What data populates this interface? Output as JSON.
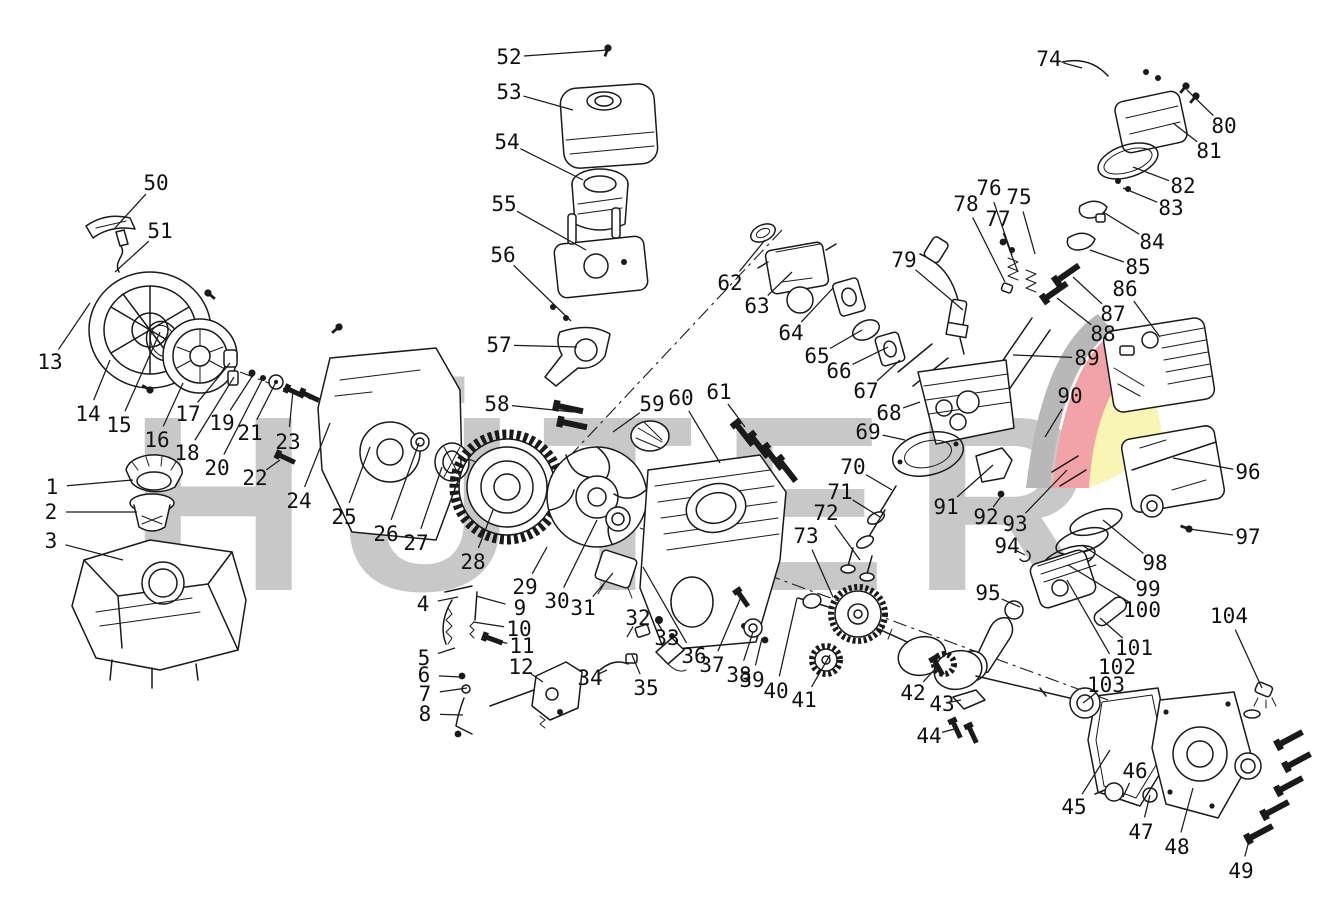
{
  "meta": {
    "background_color": "#ffffff",
    "line_color": "#1a1a1a",
    "label_color": "#111111"
  },
  "watermark": {
    "text": "HÜTER",
    "letter_color": "#c8c8c8",
    "swoosh_gray": "#b8b8b8",
    "swoosh_red": "#f2a3a8",
    "swoosh_yellow": "#f9f5b4"
  },
  "diagram": {
    "type": "exploded-parts-diagram",
    "subject": "gasoline engine exploded view with numbered part callouts",
    "labels": [
      {
        "n": "1",
        "x": 52,
        "y": 487,
        "tx": 133,
        "ty": 480
      },
      {
        "n": "2",
        "x": 51,
        "y": 512,
        "tx": 137,
        "ty": 512
      },
      {
        "n": "3",
        "x": 51,
        "y": 541,
        "tx": 123,
        "ty": 560
      },
      {
        "n": "4",
        "x": 423,
        "y": 604,
        "tx": 458,
        "ty": 597
      },
      {
        "n": "5",
        "x": 424,
        "y": 658,
        "tx": 455,
        "ty": 648
      },
      {
        "n": "6",
        "x": 424,
        "y": 675,
        "tx": 460,
        "ty": 677
      },
      {
        "n": "7",
        "x": 425,
        "y": 694,
        "tx": 467,
        "ty": 688
      },
      {
        "n": "8",
        "x": 425,
        "y": 714,
        "tx": 463,
        "ty": 715
      },
      {
        "n": "9",
        "x": 520,
        "y": 608,
        "tx": 476,
        "ty": 596
      },
      {
        "n": "10",
        "x": 519,
        "y": 629,
        "tx": 473,
        "ty": 622
      },
      {
        "n": "11",
        "x": 522,
        "y": 646,
        "tx": 485,
        "ty": 639
      },
      {
        "n": "12",
        "x": 521,
        "y": 667,
        "tx": 543,
        "ty": 682
      },
      {
        "n": "13",
        "x": 50,
        "y": 362,
        "tx": 90,
        "ty": 303
      },
      {
        "n": "14",
        "x": 88,
        "y": 414,
        "tx": 110,
        "ty": 360
      },
      {
        "n": "15",
        "x": 119,
        "y": 425,
        "tx": 160,
        "ty": 332
      },
      {
        "n": "16",
        "x": 157,
        "y": 440,
        "tx": 183,
        "ty": 383
      },
      {
        "n": "17",
        "x": 188,
        "y": 414,
        "tx": 230,
        "ty": 363
      },
      {
        "n": "18",
        "x": 187,
        "y": 453,
        "tx": 234,
        "ty": 377
      },
      {
        "n": "19",
        "x": 222,
        "y": 423,
        "tx": 253,
        "ty": 375
      },
      {
        "n": "20",
        "x": 217,
        "y": 468,
        "tx": 263,
        "ty": 378
      },
      {
        "n": "21",
        "x": 250,
        "y": 433,
        "tx": 277,
        "ty": 380
      },
      {
        "n": "22",
        "x": 255,
        "y": 478,
        "tx": 280,
        "ty": 460
      },
      {
        "n": "23",
        "x": 288,
        "y": 442,
        "tx": 293,
        "ty": 390
      },
      {
        "n": "24",
        "x": 299,
        "y": 501,
        "tx": 330,
        "ty": 423
      },
      {
        "n": "25",
        "x": 344,
        "y": 517,
        "tx": 370,
        "ty": 447
      },
      {
        "n": "26",
        "x": 386,
        "y": 534,
        "tx": 419,
        "ty": 443
      },
      {
        "n": "27",
        "x": 416,
        "y": 543,
        "tx": 442,
        "ty": 467
      },
      {
        "n": "28",
        "x": 473,
        "y": 562,
        "tx": 493,
        "ty": 510
      },
      {
        "n": "29",
        "x": 525,
        "y": 587,
        "tx": 547,
        "ty": 547
      },
      {
        "n": "30",
        "x": 557,
        "y": 601,
        "tx": 597,
        "ty": 520
      },
      {
        "n": "31",
        "x": 583,
        "y": 608,
        "tx": 613,
        "ty": 573
      },
      {
        "n": "32",
        "x": 638,
        "y": 618,
        "tx": 627,
        "ty": 637
      },
      {
        "n": "33",
        "x": 667,
        "y": 638,
        "tx": 657,
        "ty": 622
      },
      {
        "n": "34",
        "x": 590,
        "y": 678,
        "tx": 607,
        "ty": 670
      },
      {
        "n": "35",
        "x": 646,
        "y": 688,
        "tx": 632,
        "ty": 655
      },
      {
        "n": "36",
        "x": 694,
        "y": 656,
        "tx": 643,
        "ty": 567
      },
      {
        "n": "37",
        "x": 712,
        "y": 665,
        "tx": 741,
        "ty": 597
      },
      {
        "n": "38",
        "x": 739,
        "y": 675,
        "tx": 753,
        "ty": 632
      },
      {
        "n": "39",
        "x": 752,
        "y": 680,
        "tx": 762,
        "ty": 638
      },
      {
        "n": "40",
        "x": 776,
        "y": 691,
        "tx": 797,
        "ty": 598
      },
      {
        "n": "41",
        "x": 804,
        "y": 700,
        "tx": 830,
        "ty": 655
      },
      {
        "n": "42",
        "x": 913,
        "y": 693,
        "tx": 937,
        "ty": 667
      },
      {
        "n": "43",
        "x": 942,
        "y": 704,
        "tx": 961,
        "ty": 700
      },
      {
        "n": "44",
        "x": 929,
        "y": 736,
        "tx": 958,
        "ty": 728
      },
      {
        "n": "45",
        "x": 1074,
        "y": 807,
        "tx": 1110,
        "ty": 750
      },
      {
        "n": "46",
        "x": 1135,
        "y": 771,
        "tx": 1123,
        "ty": 797
      },
      {
        "n": "47",
        "x": 1141,
        "y": 832,
        "tx": 1150,
        "ty": 795
      },
      {
        "n": "48",
        "x": 1177,
        "y": 847,
        "tx": 1193,
        "ty": 788
      },
      {
        "n": "49",
        "x": 1241,
        "y": 871,
        "tx": 1250,
        "ty": 837
      },
      {
        "n": "50",
        "x": 156,
        "y": 183,
        "tx": 115,
        "ty": 228
      },
      {
        "n": "51",
        "x": 160,
        "y": 231,
        "tx": 115,
        "ty": 272
      },
      {
        "n": "52",
        "x": 509,
        "y": 57,
        "tx": 608,
        "ty": 50
      },
      {
        "n": "53",
        "x": 509,
        "y": 92,
        "tx": 573,
        "ty": 110
      },
      {
        "n": "54",
        "x": 507,
        "y": 142,
        "tx": 583,
        "ty": 180
      },
      {
        "n": "55",
        "x": 504,
        "y": 204,
        "tx": 586,
        "ty": 250
      },
      {
        "n": "56",
        "x": 503,
        "y": 255,
        "tx": 571,
        "ty": 321
      },
      {
        "n": "57",
        "x": 499,
        "y": 345,
        "tx": 577,
        "ty": 347
      },
      {
        "n": "58",
        "x": 497,
        "y": 404,
        "tx": 573,
        "ty": 412
      },
      {
        "n": "59",
        "x": 652,
        "y": 404,
        "tx": 613,
        "ty": 432
      },
      {
        "n": "60",
        "x": 681,
        "y": 398,
        "tx": 720,
        "ty": 463
      },
      {
        "n": "61",
        "x": 719,
        "y": 392,
        "tx": 745,
        "ty": 427
      },
      {
        "n": "62",
        "x": 730,
        "y": 283,
        "tx": 765,
        "ty": 240
      },
      {
        "n": "63",
        "x": 757,
        "y": 306,
        "tx": 792,
        "ty": 272
      },
      {
        "n": "64",
        "x": 791,
        "y": 333,
        "tx": 833,
        "ty": 288
      },
      {
        "n": "65",
        "x": 817,
        "y": 356,
        "tx": 862,
        "ty": 330
      },
      {
        "n": "66",
        "x": 839,
        "y": 371,
        "tx": 888,
        "ty": 347
      },
      {
        "n": "67",
        "x": 866,
        "y": 391,
        "tx": 900,
        "ty": 360
      },
      {
        "n": "68",
        "x": 889,
        "y": 413,
        "tx": 920,
        "ty": 402
      },
      {
        "n": "69",
        "x": 868,
        "y": 432,
        "tx": 905,
        "ty": 440
      },
      {
        "n": "70",
        "x": 853,
        "y": 467,
        "tx": 892,
        "ty": 490
      },
      {
        "n": "71",
        "x": 840,
        "y": 492,
        "tx": 880,
        "ty": 517
      },
      {
        "n": "72",
        "x": 826,
        "y": 513,
        "tx": 860,
        "ty": 560
      },
      {
        "n": "73",
        "x": 806,
        "y": 536,
        "tx": 833,
        "ty": 597
      },
      {
        "n": "74",
        "x": 1049,
        "y": 59,
        "tx": 1082,
        "ty": 68
      },
      {
        "n": "75",
        "x": 1019,
        "y": 197,
        "tx": 1035,
        "ty": 254
      },
      {
        "n": "76",
        "x": 989,
        "y": 188,
        "tx": 1012,
        "ty": 255
      },
      {
        "n": "77",
        "x": 998,
        "y": 219,
        "tx": 1018,
        "ty": 272
      },
      {
        "n": "78",
        "x": 966,
        "y": 204,
        "tx": 1005,
        "ty": 282
      },
      {
        "n": "79",
        "x": 904,
        "y": 260,
        "tx": 963,
        "ty": 310
      },
      {
        "n": "80",
        "x": 1224,
        "y": 126,
        "tx": 1187,
        "ty": 90
      },
      {
        "n": "81",
        "x": 1209,
        "y": 151,
        "tx": 1173,
        "ty": 123
      },
      {
        "n": "82",
        "x": 1183,
        "y": 186,
        "tx": 1133,
        "ty": 167
      },
      {
        "n": "83",
        "x": 1171,
        "y": 208,
        "tx": 1123,
        "ty": 188
      },
      {
        "n": "84",
        "x": 1152,
        "y": 242,
        "tx": 1103,
        "ty": 212
      },
      {
        "n": "85",
        "x": 1138,
        "y": 267,
        "tx": 1090,
        "ty": 250
      },
      {
        "n": "86",
        "x": 1125,
        "y": 289,
        "tx": 1160,
        "ty": 337
      },
      {
        "n": "87",
        "x": 1113,
        "y": 314,
        "tx": 1073,
        "ty": 277
      },
      {
        "n": "88",
        "x": 1103,
        "y": 334,
        "tx": 1057,
        "ty": 298
      },
      {
        "n": "89",
        "x": 1087,
        "y": 358,
        "tx": 1013,
        "ty": 355
      },
      {
        "n": "90",
        "x": 1070,
        "y": 396,
        "tx": 1045,
        "ty": 437
      },
      {
        "n": "91",
        "x": 946,
        "y": 507,
        "tx": 993,
        "ty": 465
      },
      {
        "n": "92",
        "x": 986,
        "y": 517,
        "tx": 1002,
        "ty": 495
      },
      {
        "n": "93",
        "x": 1015,
        "y": 524,
        "tx": 1067,
        "ty": 470
      },
      {
        "n": "94",
        "x": 1007,
        "y": 546,
        "tx": 1025,
        "ty": 555
      },
      {
        "n": "95",
        "x": 988,
        "y": 593,
        "tx": 1020,
        "ty": 607
      },
      {
        "n": "96",
        "x": 1248,
        "y": 472,
        "tx": 1173,
        "ty": 458
      },
      {
        "n": "97",
        "x": 1248,
        "y": 537,
        "tx": 1189,
        "ty": 529
      },
      {
        "n": "98",
        "x": 1155,
        "y": 563,
        "tx": 1103,
        "ty": 520
      },
      {
        "n": "99",
        "x": 1148,
        "y": 589,
        "tx": 1082,
        "ty": 545
      },
      {
        "n": "100",
        "x": 1142,
        "y": 610,
        "tx": 1068,
        "ty": 565
      },
      {
        "n": "101",
        "x": 1134,
        "y": 648,
        "tx": 1100,
        "ty": 618
      },
      {
        "n": "102",
        "x": 1117,
        "y": 667,
        "tx": 1067,
        "ty": 580
      },
      {
        "n": "103",
        "x": 1106,
        "y": 685,
        "tx": 1083,
        "ty": 703
      },
      {
        "n": "104",
        "x": 1229,
        "y": 616,
        "tx": 1262,
        "ty": 688
      }
    ]
  }
}
